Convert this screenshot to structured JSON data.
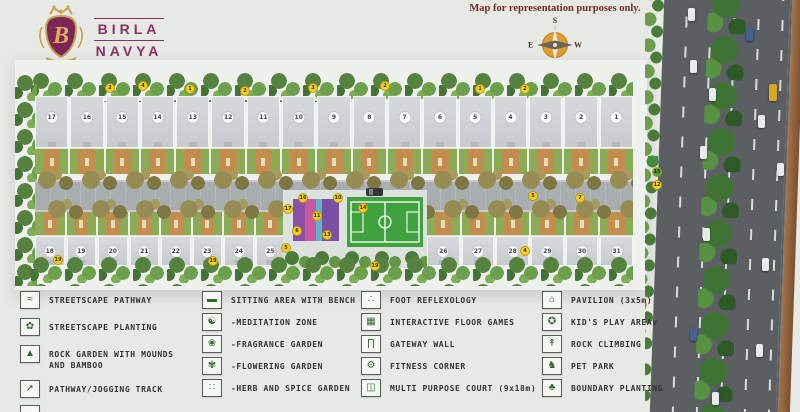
{
  "header": {
    "logo": {
      "line1": "BIRLA",
      "line2": "NAVYA",
      "city": "GURGRAM",
      "monogram": "B"
    },
    "disclaimer": "Map for representation purposes only.",
    "compass": {
      "top": "S",
      "bottom": "N",
      "left": "E",
      "right": "W"
    }
  },
  "site": {
    "top_row": [
      "17",
      "16",
      "15",
      "14",
      "13",
      "12",
      "11",
      "10",
      "9",
      "8",
      "7",
      "6",
      "5",
      "4",
      "3",
      "2",
      "1"
    ],
    "bottom_row_left": [
      "18",
      "19",
      "20",
      "21",
      "22",
      "23",
      "24",
      "25"
    ],
    "bottom_row_right": [
      "26",
      "27",
      "28",
      "29",
      "30",
      "31"
    ],
    "markers": [
      {
        "x": 105,
        "y": 83,
        "label": "2"
      },
      {
        "x": 138,
        "y": 81,
        "label": "4"
      },
      {
        "x": 185,
        "y": 84,
        "label": "1"
      },
      {
        "x": 240,
        "y": 86,
        "label": "2"
      },
      {
        "x": 308,
        "y": 83,
        "label": "3"
      },
      {
        "x": 380,
        "y": 81,
        "label": "2"
      },
      {
        "x": 475,
        "y": 84,
        "label": "1"
      },
      {
        "x": 520,
        "y": 84,
        "label": "2"
      },
      {
        "x": 298,
        "y": 193,
        "label": "16"
      },
      {
        "x": 283,
        "y": 204,
        "label": "17"
      },
      {
        "x": 292,
        "y": 226,
        "label": "6"
      },
      {
        "x": 281,
        "y": 243,
        "label": "5"
      },
      {
        "x": 312,
        "y": 211,
        "label": "11"
      },
      {
        "x": 322,
        "y": 230,
        "label": "13"
      },
      {
        "x": 333,
        "y": 193,
        "label": "10"
      },
      {
        "x": 358,
        "y": 203,
        "label": "14"
      },
      {
        "x": 53,
        "y": 255,
        "label": "19"
      },
      {
        "x": 208,
        "y": 256,
        "label": "19"
      },
      {
        "x": 370,
        "y": 261,
        "label": "19"
      },
      {
        "x": 520,
        "y": 246,
        "label": "4"
      },
      {
        "x": 528,
        "y": 191,
        "label": "5"
      },
      {
        "x": 575,
        "y": 193,
        "label": "7"
      },
      {
        "x": 652,
        "y": 180,
        "label": "12"
      },
      {
        "x": 652,
        "y": 167,
        "label": "15",
        "color": "#49a04b"
      }
    ],
    "vehicles": [
      {
        "x": 688,
        "y": 8,
        "color": "#e9eaea"
      },
      {
        "x": 746,
        "y": 28,
        "color": "#47608f"
      },
      {
        "x": 690,
        "y": 60,
        "color": "#e9eaea"
      },
      {
        "x": 709,
        "y": 88,
        "color": "#e9eaea"
      },
      {
        "x": 769,
        "y": 84,
        "color": "#d9a61f",
        "w": 8,
        "h": 17
      },
      {
        "x": 758,
        "y": 115,
        "color": "#e9eaea"
      },
      {
        "x": 700,
        "y": 146,
        "color": "#e9eaea"
      },
      {
        "x": 777,
        "y": 163,
        "color": "#e9eaea"
      },
      {
        "x": 703,
        "y": 228,
        "color": "#e9eaea"
      },
      {
        "x": 762,
        "y": 258,
        "color": "#e9eaea"
      },
      {
        "x": 690,
        "y": 328,
        "color": "#47608f"
      },
      {
        "x": 756,
        "y": 344,
        "color": "#e9eaea"
      },
      {
        "x": 712,
        "y": 392,
        "color": "#e9eaea"
      }
    ]
  },
  "legend": {
    "col1": [
      {
        "label": "STREETSCAPE PATHWAY",
        "icon": "streetscape-pathway-icon",
        "glyph": "≈"
      },
      {
        "label": "STREETSCAPE PLANTING",
        "icon": "streetscape-planting-icon",
        "glyph": "✿"
      },
      {
        "label": "ROCK GARDEN WITH MOUNDS AND BAMBOO",
        "icon": "rock-garden-icon",
        "glyph": "▲"
      },
      {
        "label": "PATHWAY/JOGGING TRACK",
        "icon": "jogging-track-icon",
        "glyph": "➚"
      }
    ],
    "col2": [
      {
        "label": "SITTING AREA WITH BENCH",
        "icon": "sitting-area-bench-icon",
        "glyph": "▬"
      },
      {
        "label": "-MEDITATION ZONE",
        "icon": "meditation-zone-icon",
        "glyph": "☯"
      },
      {
        "label": "-FRAGRANCE GARDEN",
        "icon": "fragrance-garden-icon",
        "glyph": "❀"
      },
      {
        "label": "-FLOWERING GARDEN",
        "icon": "flowering-garden-icon",
        "glyph": "✾"
      },
      {
        "label": "-HERB AND SPICE GARDEN",
        "icon": "herb-spice-garden-icon",
        "glyph": "∷"
      }
    ],
    "col3": [
      {
        "label": "FOOT REFLEXOLOGY",
        "icon": "foot-reflexology-icon",
        "glyph": "∴"
      },
      {
        "label": "INTERACTIVE FLOOR GAMES",
        "icon": "interactive-floor-games-icon",
        "glyph": "▦"
      },
      {
        "label": "GATEWAY WALL",
        "icon": "gateway-wall-icon",
        "glyph": "∏"
      },
      {
        "label": "FITNESS CORNER",
        "icon": "fitness-corner-icon",
        "glyph": "⚙"
      },
      {
        "label": "MULTI PURPOSE COURT (9x18m)",
        "icon": "multi-purpose-court-icon",
        "glyph": "◫"
      }
    ],
    "col4": [
      {
        "label": "PAVILION (3x5m)",
        "icon": "pavilion-icon",
        "glyph": "⌂"
      },
      {
        "label": "KID'S PLAY AREAv",
        "icon": "kids-play-area-icon",
        "glyph": "✪"
      },
      {
        "label": "ROCK CLIMBING",
        "icon": "rock-climbing-icon",
        "glyph": "↟"
      },
      {
        "label": "PET PARK",
        "icon": "pet-park-icon",
        "glyph": "♞"
      },
      {
        "label": "BOUNDARY PLANTING",
        "icon": "boundary-planting-icon",
        "glyph": "♣"
      }
    ]
  },
  "colors": {
    "accent_purple": "#8d2f66",
    "disclaimer_maroon": "#7b2a22",
    "marker_yellow": "#f3cf25",
    "court_green": "#3fa23f",
    "play_purple": "#8a4fa6",
    "courtyard_orange": "#c28e4f",
    "compass_orange": "#dc9e33",
    "highway_gray": "#5b5f62"
  }
}
